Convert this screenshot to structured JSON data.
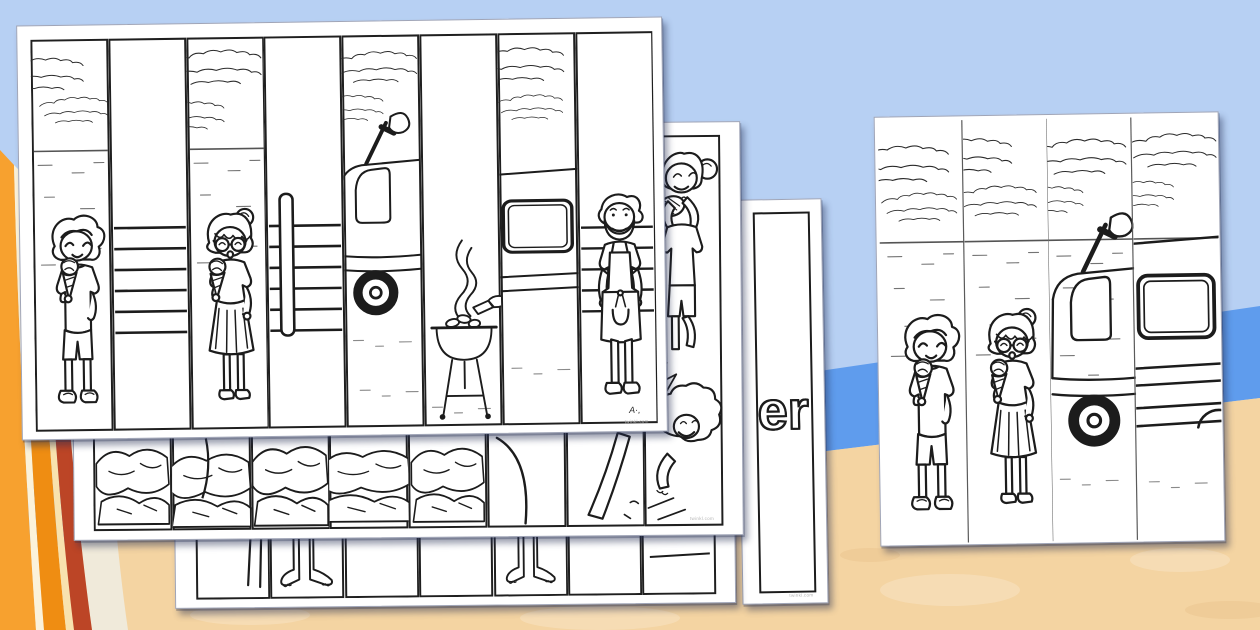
{
  "background": {
    "sky_color": "#b7d0f3",
    "sea_color": "#5f9ced",
    "sand_color": "#f4d4a2",
    "towel_stripe_colors": [
      "#f7a12f",
      "#fbf2da",
      "#ef8d12",
      "#f8e2ae",
      "#bc4526",
      "#f0eada"
    ],
    "ink_color": "#1c1c1c",
    "page_color": "#ffffff"
  },
  "pages": {
    "front_worksheet": {
      "strips": [
        "boy-eating-ice-cream",
        "fence-rails",
        "girl-eating-ice-cream",
        "fence-rails-and-post",
        "camper-van-front-with-brush",
        "barbecue-grill-with-smoke",
        "camper-van-side-window",
        "man-in-apron"
      ],
      "signature_mark": "A·,",
      "watermark": "twinkl.com"
    },
    "second_worksheet": {
      "strips": [
        "rock-pool-cracks",
        "rock-pool-cracks",
        "rock-pool-cracks",
        "rock-pool-cracks",
        "rock-pool-cracks",
        "curved-line",
        "bare-leg",
        "girl-holding-shell-above-curly-haired-child"
      ],
      "watermark": "twinkl.com"
    },
    "third_worksheet": {
      "strips": [
        "bare-leg",
        "bare-legs-and-feet",
        "blank",
        "blank",
        "legs-in-shorts",
        "blank",
        "horizon-line"
      ]
    },
    "word_card": {
      "visible_text": "er",
      "watermark": "twinkl.com"
    },
    "solution_card": {
      "strips": [
        "boy-eating-ice-cream",
        "girl-eating-ice-cream",
        "ice-cream-van-front",
        "ice-cream-van-side"
      ]
    }
  }
}
